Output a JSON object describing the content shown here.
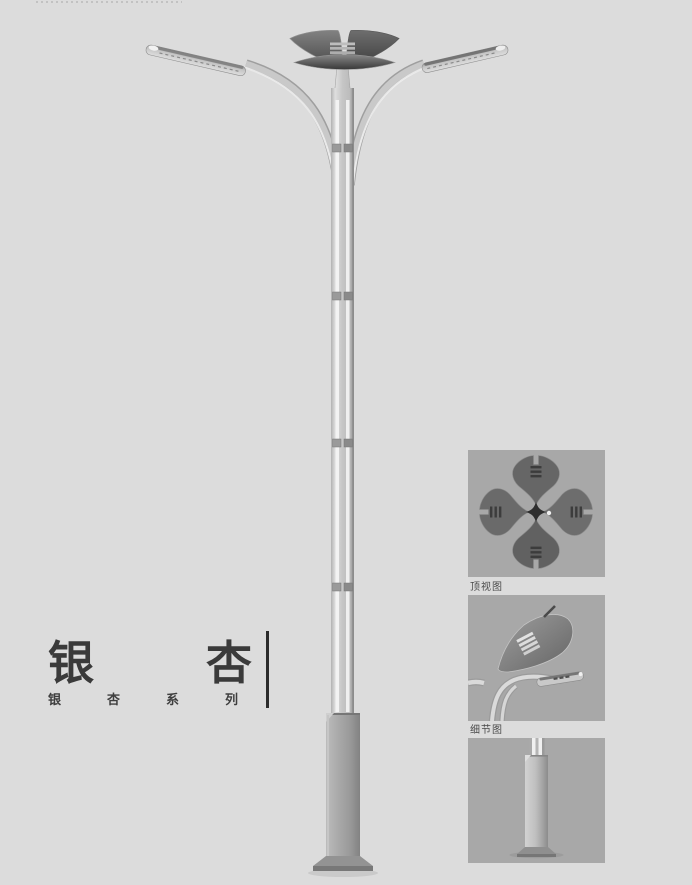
{
  "page": {
    "background": "#dcdcdc"
  },
  "title": {
    "char_1": "银",
    "char_2": "杏"
  },
  "series": {
    "full": "银杏系列",
    "char_1": "银",
    "char_2": "杏",
    "char_3": "系",
    "char_4": "列"
  },
  "panels": {
    "top_view": {
      "label": "顶视图",
      "figure": "lamp-top-view-four-ginkgo-leaves"
    },
    "detail_view": {
      "label": "细节图",
      "figure": "lamp-crown-and-arm-detail"
    },
    "base_view": {
      "figure": "lamp-square-base-column"
    }
  },
  "illustration": {
    "main_figure": "ginkgo-double-arm-street-lamp-full-view"
  },
  "colors": {
    "page_background": "#dcdcdc",
    "panel_background": "#a8a8a8",
    "title_text": "#3a3a3a",
    "label_text": "#4a4a4a",
    "crown_dark": "#4a4a4a",
    "metal_light": "#d0d0d0",
    "metal_mid": "#a8a8a8",
    "base_gray": "#9a9a9a"
  }
}
